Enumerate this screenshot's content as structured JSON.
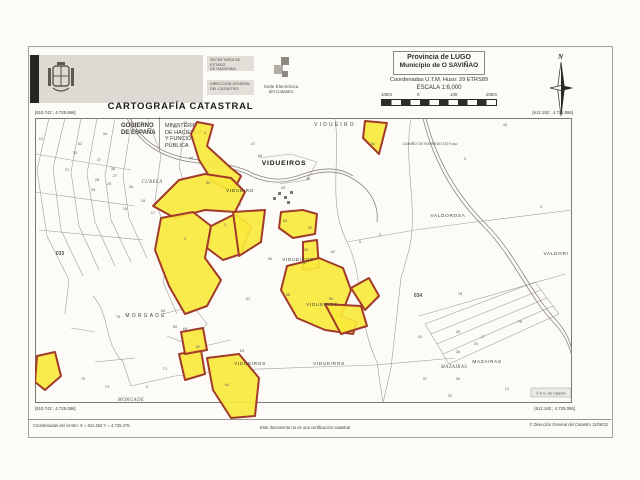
{
  "header": {
    "logo": {
      "gobierno": "GOBIERNO\nDE ESPAÑA",
      "ministerio": "MINISTERIO\nDE HACIENDA\nY FUNCIÓN PÚBLICA",
      "secretaria": "SECRETARÍA DE ESTADO\nDE HACIENDA",
      "direccion": "DIRECCIÓN GENERAL\nDEL CATASTRO",
      "sede": "Sede Electrónica\ndel Catastro"
    },
    "title": "CARTOGRAFÍA CATASTRAL",
    "province": "Provincia de LUGO",
    "municipality": "Municipio de O SAVIÑAO",
    "utm": "Coordenadas U.T.M. Huso: 29 ETRS89",
    "scale": "ESCALA 1:6,000",
    "scalebar_labels": [
      "100m",
      "0",
      "100",
      "200m"
    ],
    "north_label": "N"
  },
  "map": {
    "corner_coords": {
      "top_left": "[610.742 ; 4.725.866]",
      "top_right": "[612.182 ; 4.725.866]",
      "bottom_left": "[610.742 ; 4.725.086]",
      "bottom_right": "[612.182 ; 4.725.086]"
    },
    "copyright_box": "© D.G. del Catastro",
    "colors": {
      "highlight_fill": "#f9e93c",
      "highlight_stroke": "#a13a2b",
      "parcel_line": "#a09d94",
      "road_line": "#8a877e",
      "frame": "#6b6b66"
    },
    "svg": {
      "w": 537,
      "h": 302,
      "frame_h": 285,
      "lines": [
        "M14,0 L2,52 L12,118 L34,162 L30,196",
        "M30,0 L18,50 L26,112 L48,158",
        "M46,0 L36,54 L44,108 L64,152",
        "M62,0 L52,56 L60,104 L80,148",
        "M80,0 L70,58 L76,102 L96,144",
        "M97,0 L88,58 L94,100 L112,140",
        "M0,36 L96,52",
        "M0,74 L100,88",
        "M4,112 L108,122",
        "M112,0 L126,36 L120,84 L136,124 L128,164 L142,196",
        "M150,10 L144,48 L154,84",
        "M224,40 L256,36 L282,44 L272,62 L244,66",
        "M300,0 C306,44 292,84 312,124 C330,160 322,204 342,244 L348,285",
        "M376,0 C368,46 384,92 374,132 L366,160",
        "M312,124 L380,112 L440,104 L537,92",
        "M384,198 L530,156",
        "M390,206 L500,164",
        "M396,216 L506,172",
        "M402,226 L512,180",
        "M408,236 L518,188",
        "M414,246 L524,196",
        "M390,206 L414,246",
        "M500,164 L524,196",
        "M58,178 C76,198 68,224 88,244 L96,268",
        "M128,196 L158,188 L172,206 L152,226 L132,218",
        "M96,268 L140,258 L196,252 L340,247 L420,240",
        "M36,210 L60,214",
        "M60,244 L100,240",
        "M160,230 L196,222",
        "M348,285 L356,250 L366,160"
      ],
      "roads": [
        "M92,0 C104,26 128,40 156,44 C186,48 206,52 216,58",
        "M95,0 C107,24 129,37 157,41 C187,45 207,49 217,55",
        "M216,58 C236,67 252,65 268,59 C290,51 306,53 318,61",
        "M217,55 C237,64 252,62 268,56 C290,48 306,50 318,58",
        "M318,61 C334,70 344,86 342,104",
        "M388,0 C398,42 418,78 448,108 C478,138 492,176 518,204 C530,216 534,228 537,238",
        "M391,0 C401,41 421,76 451,106 C481,136 495,174 521,202 C532,214 536,226 537,234"
      ],
      "parcels": [
        "162,4 178,7 172,28 196,50 206,58 198,74 178,64 164,42 156,16",
        "330,3 352,5 344,36 328,20",
        "118,88 144,62 170,56 196,60 210,74 200,94 170,92 140,100",
        "126,100 158,94 176,108 170,140 186,162 172,188 150,196 134,168 120,132",
        "176,108 200,96 216,108 206,136 188,142 172,130",
        "198,94 230,92 226,124 204,138",
        "246,94 268,92 282,96 280,116 258,120 244,110",
        "268,124 282,122 284,150 268,152",
        "252,148 284,140 308,150 316,172 306,198 322,204 318,216 290,212 262,200 246,172",
        "290,186 326,188 332,208 306,216",
        "316,170 334,160 344,178 330,192",
        "144,236 166,232 170,256 150,262",
        "2,238 20,234 26,258 10,272 0,264",
        "146,214 168,210 172,232 150,236",
        "172,240 204,236 224,260 220,298 196,300 178,272"
      ],
      "buildings": [
        [
          243,
          74
        ],
        [
          249,
          78
        ],
        [
          255,
          73
        ],
        [
          238,
          79
        ],
        [
          252,
          83
        ]
      ],
      "labels": [
        {
          "x": 300,
          "y": 8,
          "t": "VIDUEIRO",
          "cls": "place-sp"
        },
        {
          "x": 395,
          "y": 27,
          "t": "CAMIÑO DE SOBREDO DO Fuso",
          "cls": "tiny"
        },
        {
          "x": 249,
          "y": 47,
          "t": "VIDUEIROS",
          "cls": "town"
        },
        {
          "x": 117,
          "y": 65,
          "t": "CUBELA",
          "cls": "italic"
        },
        {
          "x": 205,
          "y": 74,
          "t": "VIDUEIRO",
          "cls": "place"
        },
        {
          "x": 263,
          "y": 143,
          "t": "VIDUEIROS",
          "cls": "place"
        },
        {
          "x": 287,
          "y": 188,
          "t": "VIDUEIROS",
          "cls": "place"
        },
        {
          "x": 413,
          "y": 99,
          "t": "VALDOROSA",
          "cls": "place"
        },
        {
          "x": 521,
          "y": 137,
          "t": "VALDORI",
          "cls": "place"
        },
        {
          "x": 111,
          "y": 199,
          "t": "MORGADE",
          "cls": "place-sp"
        },
        {
          "x": 215,
          "y": 247,
          "t": "VIDUEIROS",
          "cls": "place"
        },
        {
          "x": 294,
          "y": 247,
          "t": "VIDUEIROS",
          "cls": "place"
        },
        {
          "x": 452,
          "y": 245,
          "t": "MAZAIRAS",
          "cls": "place"
        },
        {
          "x": 419,
          "y": 250,
          "t": "MAZAIRAS",
          "cls": "italic"
        },
        {
          "x": 96,
          "y": 283,
          "t": "MORGADE",
          "cls": "italic"
        },
        {
          "x": 25,
          "y": 137,
          "t": "033",
          "cls": "zone"
        },
        {
          "x": 383,
          "y": 179,
          "t": "034",
          "cls": "zone"
        }
      ],
      "numbers": [
        [
          6,
          22,
          "12"
        ],
        [
          70,
          17,
          "34"
        ],
        [
          45,
          27,
          "52"
        ],
        [
          40,
          36,
          "33"
        ],
        [
          64,
          43,
          "37"
        ],
        [
          32,
          53,
          "21"
        ],
        [
          78,
          52,
          "38"
        ],
        [
          62,
          63,
          "28"
        ],
        [
          80,
          59,
          "27"
        ],
        [
          74,
          67,
          "29"
        ],
        [
          58,
          73,
          "25"
        ],
        [
          96,
          70,
          "26"
        ],
        [
          108,
          84,
          "18"
        ],
        [
          90,
          92,
          "15"
        ],
        [
          118,
          96,
          "17"
        ],
        [
          140,
          10,
          "24"
        ],
        [
          150,
          6,
          "45"
        ],
        [
          170,
          16,
          "4"
        ],
        [
          156,
          41,
          "44"
        ],
        [
          218,
          27,
          "47"
        ],
        [
          225,
          39,
          "63"
        ],
        [
          173,
          66,
          "59"
        ],
        [
          248,
          71,
          "43"
        ],
        [
          205,
          88,
          "1"
        ],
        [
          190,
          108,
          "2"
        ],
        [
          150,
          122,
          "3"
        ],
        [
          273,
          62,
          "46"
        ],
        [
          338,
          27,
          "54"
        ],
        [
          250,
          104,
          "53"
        ],
        [
          275,
          111,
          "52"
        ],
        [
          271,
          133,
          "50"
        ],
        [
          235,
          142,
          "56"
        ],
        [
          270,
          146,
          "57"
        ],
        [
          253,
          178,
          "58"
        ],
        [
          296,
          182,
          "59"
        ],
        [
          213,
          182,
          "61"
        ],
        [
          298,
          135,
          "82"
        ],
        [
          325,
          125,
          "5"
        ],
        [
          345,
          118,
          "3"
        ],
        [
          163,
          230,
          "62"
        ],
        [
          207,
          234,
          "63"
        ],
        [
          192,
          268,
          "64"
        ],
        [
          140,
          210,
          "65"
        ],
        [
          150,
          212,
          "68"
        ],
        [
          130,
          252,
          "71"
        ],
        [
          112,
          270,
          "2"
        ],
        [
          72,
          270,
          "74"
        ],
        [
          48,
          262,
          "75"
        ],
        [
          83,
          200,
          "76"
        ],
        [
          128,
          194,
          "66"
        ],
        [
          485,
          205,
          "75"
        ],
        [
          423,
          215,
          "25"
        ],
        [
          448,
          220,
          "17"
        ],
        [
          441,
          227,
          "20"
        ],
        [
          423,
          235,
          "26"
        ],
        [
          423,
          262,
          "30"
        ],
        [
          415,
          279,
          "32"
        ],
        [
          472,
          272,
          "12"
        ],
        [
          390,
          262,
          "37"
        ],
        [
          385,
          220,
          "42"
        ],
        [
          425,
          177,
          "78"
        ],
        [
          470,
          8,
          "45"
        ],
        [
          430,
          42,
          "3"
        ],
        [
          506,
          90,
          "4"
        ]
      ]
    }
  },
  "footer": {
    "center_coords": "Coordenadas del centro: X = 611.462 Y = 4.725.476",
    "disclaimer": "Este documento no es una certificación catastral",
    "copyright": "© Dirección General del Catastro 11/06/22"
  }
}
